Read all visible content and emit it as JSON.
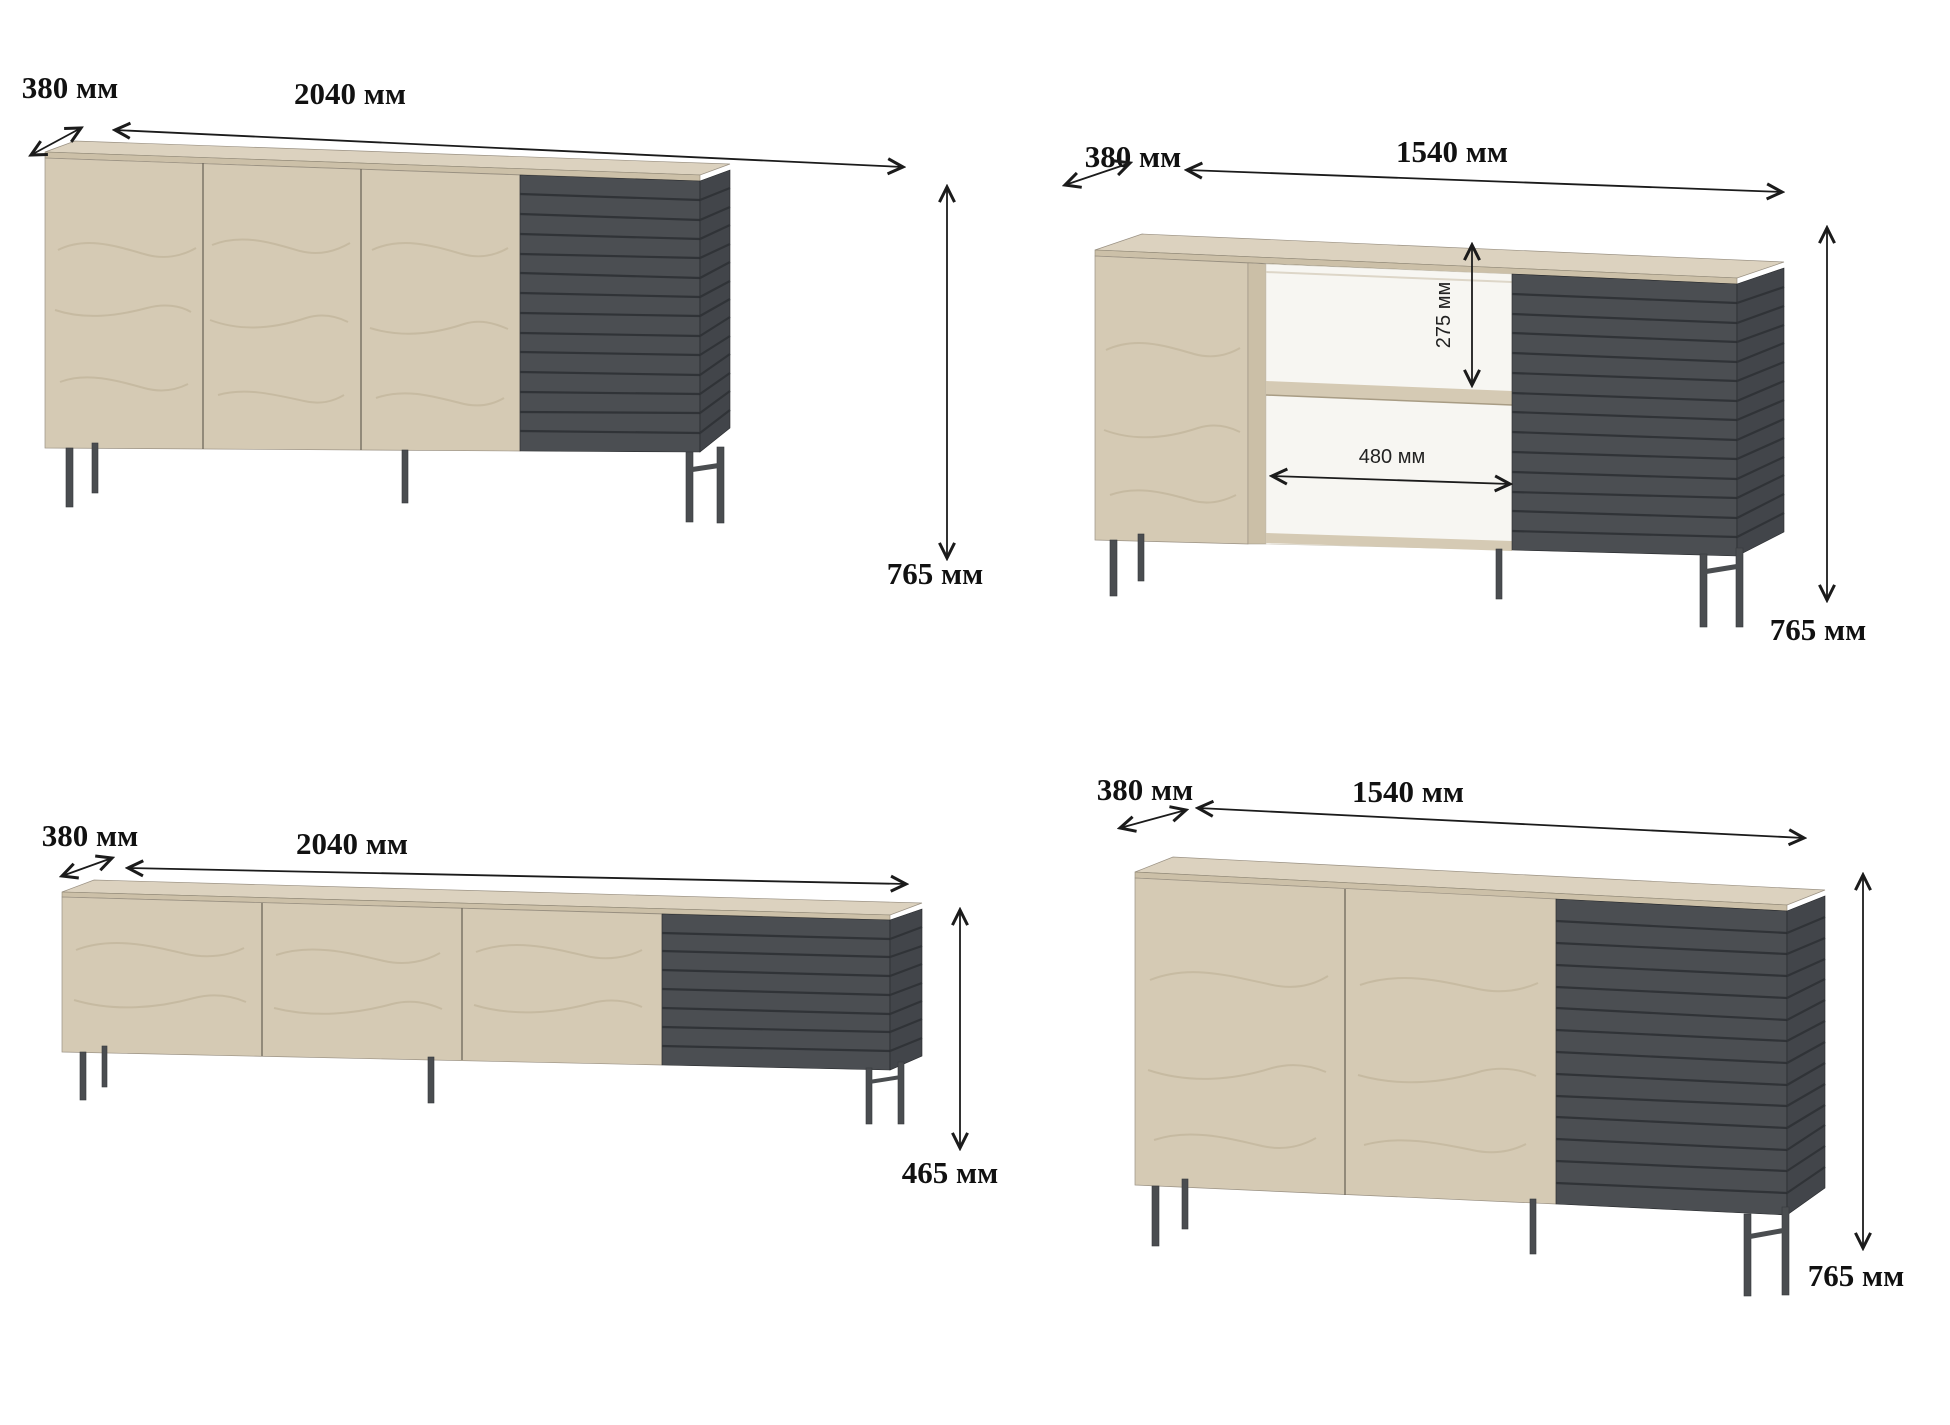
{
  "pieces": [
    {
      "name": "sideboard-2040-three-doors",
      "depth_label": "380 мм",
      "width_label": "2040 мм",
      "height_label": "765 мм"
    },
    {
      "name": "sideboard-1540-open-shelves",
      "depth_label": "380 мм",
      "width_label": "1540 мм",
      "height_label": "765 мм",
      "shelf_opening_height_label": "275 мм",
      "shelf_opening_width_label": "480 мм"
    },
    {
      "name": "tv-stand-2040-low",
      "depth_label": "380 мм",
      "width_label": "2040 мм",
      "height_label": "465 мм"
    },
    {
      "name": "sideboard-1540-two-doors",
      "depth_label": "380 мм",
      "width_label": "1540 мм",
      "height_label": "765 мм"
    }
  ],
  "colors": {
    "background": "#ffffff",
    "wood": "#d5cab4",
    "wood_top": "#dcd2bf",
    "wood_edge": "#ccc0a8",
    "wood_divider": "#cbbfa7",
    "dark_slats": "#4b4e52",
    "dark_side": "#42454a",
    "slat_gap": "#303337",
    "legs": "#4a4d50",
    "dimension_line": "#1b1b1b",
    "shelf_back": "#f7f6f2"
  }
}
